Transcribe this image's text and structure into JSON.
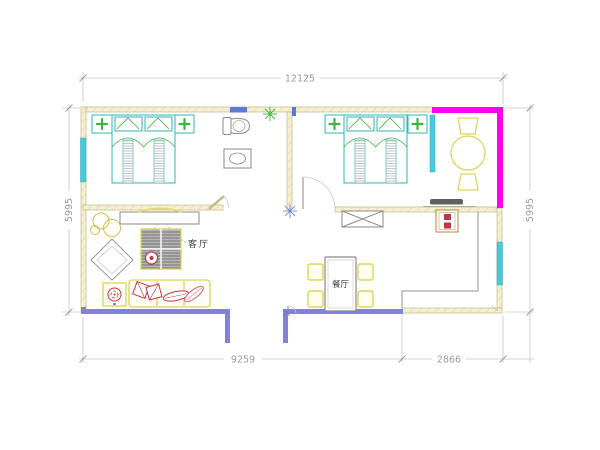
{
  "floorplan": {
    "dimensions": {
      "total_width": "12125",
      "left_height": "5995",
      "right_height": "5995",
      "bottom_left_width": "9259",
      "bottom_right_width": "2866"
    },
    "labels": {
      "living_room": "客厅",
      "dining_room": "餐厅"
    },
    "colors": {
      "highlight_wall": "#ff00f0",
      "window": "#4cc9d9",
      "window_dark": "#5b79d6",
      "exterior_wall": "#8282d8",
      "wall_fill": "#f6f0d2",
      "wall_edge": "#c2b98a",
      "furniture_yellow": "#ddd355",
      "furniture_teal": "#2fb6b6",
      "accent_red": "#c3344a",
      "accent_green": "#3db43d",
      "line_gray": "#8a8a8a",
      "dim_line": "#c6c6c6",
      "dim_text": "#9a9a9a"
    }
  }
}
